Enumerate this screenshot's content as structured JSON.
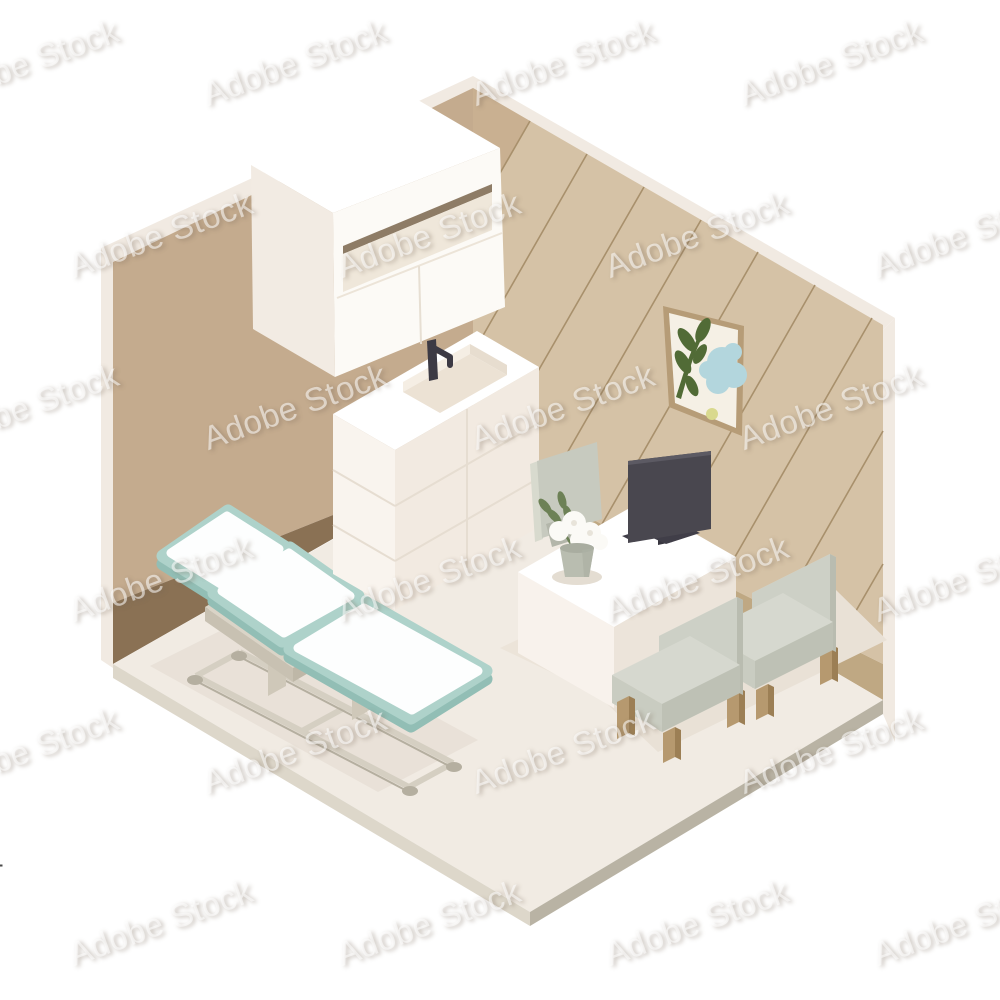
{
  "watermark": {
    "text": "Adobe Stock",
    "stock_id_label": "Adobe Stock | #816901616"
  },
  "palette": {
    "bg": "#ffffff",
    "wallEdge": "#f1eae2",
    "wallLeft": "#c4ab8e",
    "wallRight": "#d5c2a6",
    "wallRightShade": "#c9b091",
    "plankLine": "#a8906c",
    "baseboardLeft": "#8a7154",
    "baseboardRight": "#bfa883",
    "floorTop": "#f1ebe3",
    "floorSideLight": "#ddd7ca",
    "floorSideDark": "#b9b3a4",
    "shadow": "#e9e1d6",
    "white": "#ffffff",
    "creamLight": "#f9f4ee",
    "creamMid": "#f2eae1",
    "creamDark": "#ece4da",
    "slotDark": "#8e7c66",
    "recessCream": "#efe7da",
    "tealTop": "#aed2ca",
    "tealSide": "#92beb5",
    "frameGray": "#d5cfc2",
    "frameGrayDark": "#b5afa0",
    "sage": "#cdd0c6",
    "sageLight": "#dadcd2",
    "sageDark": "#bec1b5",
    "sageSeat": "#c9ccc1",
    "wood": "#b6996f",
    "woodDark": "#9c7f55",
    "monitorDark": "#49474f",
    "monitorDarker": "#38363f",
    "faucetDark": "#3c3a44",
    "leafGreen": "#516b36",
    "leafSoft": "#6d8156",
    "artBlue": "#b3d6dd",
    "artYellow": "#d9d98e",
    "frameTan": "#b69c77",
    "artPaper": "#f5f0e5",
    "vaseGray": "#b9bdb0",
    "chairBack": "#c7cabf"
  },
  "scene": {
    "objects": [
      "left-wall",
      "right-wall",
      "floor",
      "wall-cabinet",
      "sink-vanity",
      "faucet",
      "wall-art",
      "exam-table",
      "desk",
      "monitor",
      "flower-vase",
      "doctor-chair",
      "visitor-chair-front",
      "visitor-chair-back"
    ]
  }
}
